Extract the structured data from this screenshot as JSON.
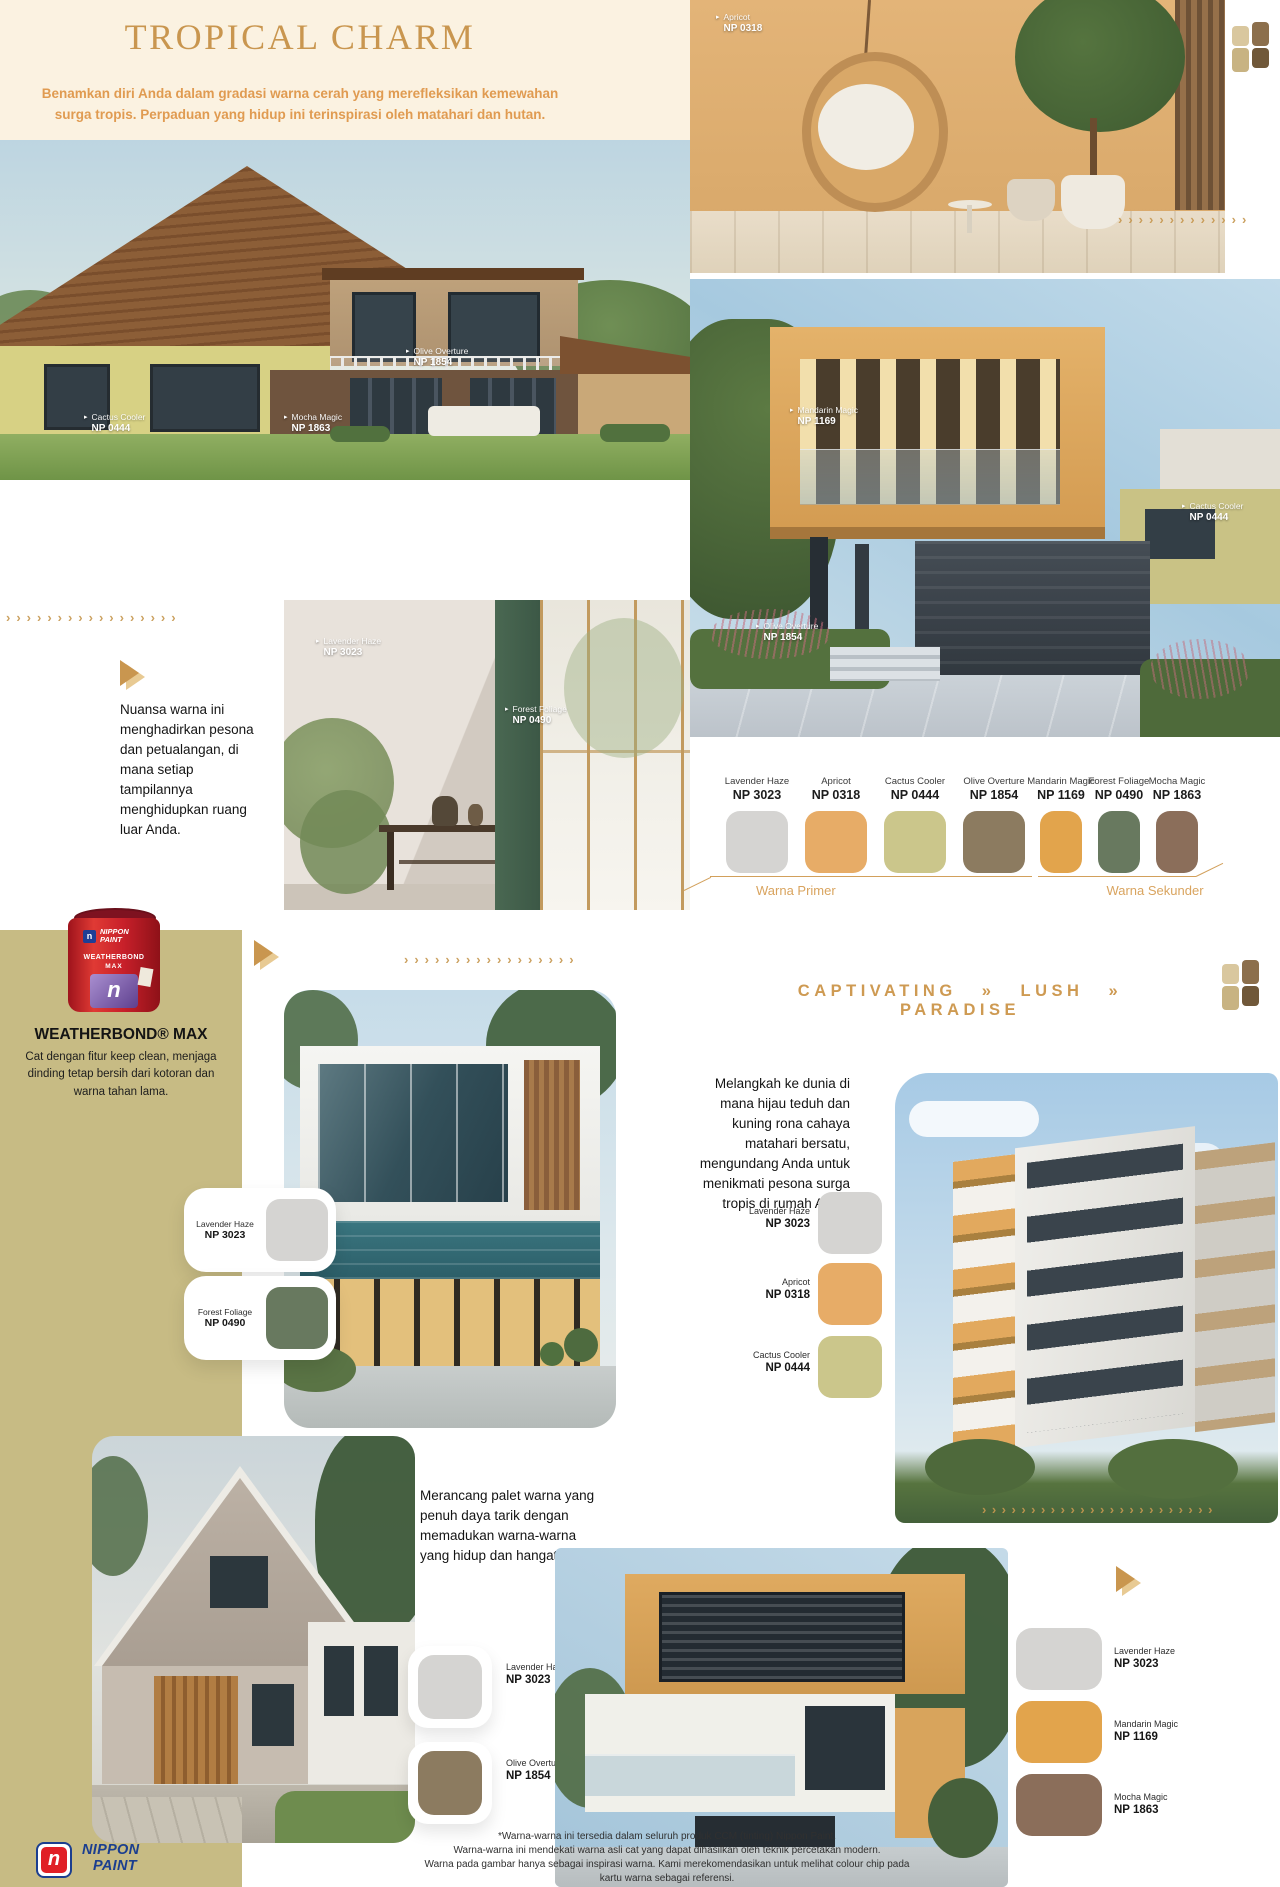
{
  "colors": {
    "accent_gold": "#C9964F",
    "subtitle_orange": "#E09B51",
    "cream_bg": "#FBF2E1",
    "olive_bg": "#C7BB84"
  },
  "header": {
    "title": "TROPICAL CHARM",
    "subtitle": "Benamkan diri Anda dalam gradasi warna cerah yang merefleksikan kemewahan surga tropis. Perpaduan yang hidup ini terinspirasi oleh matahari dan hutan."
  },
  "swatches": {
    "lavender": {
      "name": "Lavender Haze",
      "code": "NP 3023",
      "hex": "#D5D4D2"
    },
    "apricot": {
      "name": "Apricot",
      "code": "NP 0318",
      "hex": "#E7AC67"
    },
    "cactus": {
      "name": "Cactus Cooler",
      "code": "NP 0444",
      "hex": "#CBC68B"
    },
    "olive": {
      "name": "Olive Overture",
      "code": "NP 1854",
      "hex": "#8C7B60"
    },
    "mandarin": {
      "name": "Mandarin Magic",
      "code": "NP 1169",
      "hex": "#E2A44C"
    },
    "forest": {
      "name": "Forest Foliage",
      "code": "NP 0490",
      "hex": "#68795F"
    },
    "mocha": {
      "name": "Mocha Magic",
      "code": "NP 1863",
      "hex": "#8B6E5A"
    }
  },
  "palette": {
    "primer_label": "Warna Primer",
    "sekunder_label": "Warna Sekunder"
  },
  "paragraphs": {
    "outdoor": "Nuansa warna ini menghadirkan pesona dan petualangan, di mana setiap tampilannya menghidupkan ruang luar Anda.",
    "melangkah": "Melangkah ke dunia di mana hijau teduh dan kuning rona cahaya matahari bersatu, mengundang Anda untuk menikmati pesona surga tropis di rumah Anda.",
    "merancang": "Merancang palet warna yang penuh daya tarik dengan memadukan warna-warna yang hidup dan hangat."
  },
  "weatherbond": {
    "heading": "WEATHERBOND® MAX",
    "body": "Cat dengan fitur keep clean, menjaga dinding tetap bersih dari kotoran dan warna tahan lama.",
    "can": {
      "brand_line1": "NIPPON",
      "brand_line2": "PAINT",
      "product": "WEATHERBOND",
      "product2": "MAX",
      "n": "n"
    }
  },
  "captivating": {
    "heading": "CAPTIVATING » LUSH » PARADISE"
  },
  "footer": {
    "logo_n": "n",
    "logo_line1": "NIPPON",
    "logo_line2": "PAINT",
    "disclaimer": [
      "*Warna-warna ini tersedia dalam seluruh produk CCM (tinting) Nippon Paint.",
      "Warna-warna ini mendekati warna asli cat yang dapat dihasilkan oleh teknik percetakan modern.",
      "Warna pada gambar hanya sebagai inspirasi warna. Kami merekomendasikan untuk melihat colour chip pada",
      "kartu warna sebagai referensi."
    ]
  },
  "decor": {
    "marker": "▸",
    "chevrons_13": "›››››››››››››",
    "chevrons_17": "›››››››››››››››››",
    "chevrons_24": "››››››››››››››››››››››››"
  }
}
